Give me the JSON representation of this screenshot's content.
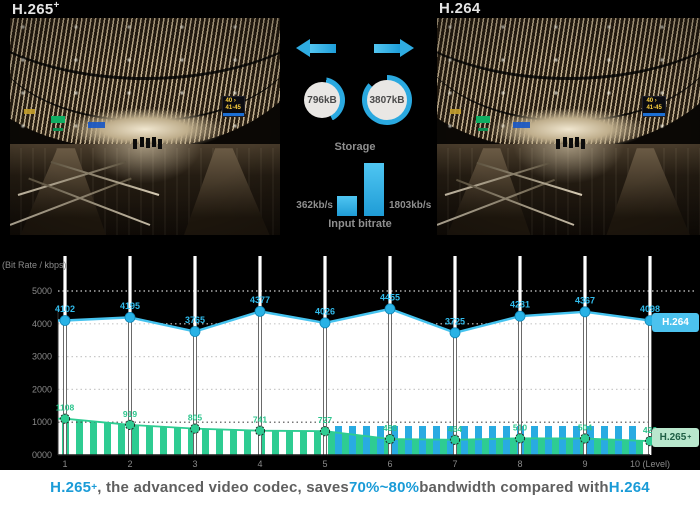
{
  "panels": {
    "left_title": "H.265",
    "left_title_sup": "+",
    "right_title": "H.264"
  },
  "photo_signs": {
    "gate": "40 ›",
    "range": "41-45"
  },
  "comparison": {
    "storage": {
      "label": "Storage",
      "h265plus_value": "796kB",
      "h264_value": "3807kB"
    },
    "input_bitrate": {
      "label": "Input bitrate",
      "h265plus_value": "362kb/s",
      "h264_value": "1803kb/s"
    },
    "accent_blue": "#29abe2"
  },
  "chart_data": {
    "type": "line",
    "title": "",
    "ylabel": "(Bit Rate / kbps)",
    "ylim": [
      0,
      5000
    ],
    "ytick_values": [
      5000,
      4000,
      3000,
      2000,
      1000,
      0
    ],
    "ytick_labels": [
      "5000",
      "4000",
      "3000",
      "2000",
      "1000",
      "0000"
    ],
    "x": [
      1,
      2,
      3,
      4,
      5,
      6,
      7,
      8,
      9,
      10
    ],
    "xtick_labels": [
      "1",
      "2",
      "3",
      "4",
      "5",
      "6",
      "7",
      "8",
      "9",
      "10 (Level)"
    ],
    "grid": "dotted-horizontal",
    "legend_position": "right",
    "series": [
      {
        "name": "H.264",
        "style": "line-markers",
        "color": "#45c3ef",
        "marker_color": "#29b2e5",
        "values": [
          4102,
          4195,
          3765,
          4377,
          4026,
          4455,
          3725,
          4231,
          4367,
          4098
        ]
      },
      {
        "name": "H.265+",
        "style": "line-markers-hatched-area",
        "color": "#2ecc92",
        "marker_color": "#2ecc92",
        "values": [
          1108,
          919,
          805,
          741,
          727,
          488,
          464,
          510,
          504,
          423
        ]
      }
    ],
    "legend": [
      {
        "label": "H.264",
        "sup": "",
        "bg": "#4cc2ee",
        "fg": "#ffffff"
      },
      {
        "label": "H.265",
        "sup": "+",
        "bg": "#b9e7cd",
        "fg": "#1f5f45"
      }
    ]
  },
  "caption": {
    "parts": [
      {
        "text": "H.265",
        "color": "#1a9bd7"
      },
      {
        "text": "+",
        "color": "#1a9bd7",
        "sup": true
      },
      {
        "text": ", the advanced video codec, saves ",
        "color": "#5f5f5f"
      },
      {
        "text": "70%~80%",
        "color": "#1a9bd7"
      },
      {
        "text": " bandwidth compared with ",
        "color": "#5f5f5f"
      },
      {
        "text": "H.264",
        "color": "#1a9bd7"
      }
    ]
  }
}
